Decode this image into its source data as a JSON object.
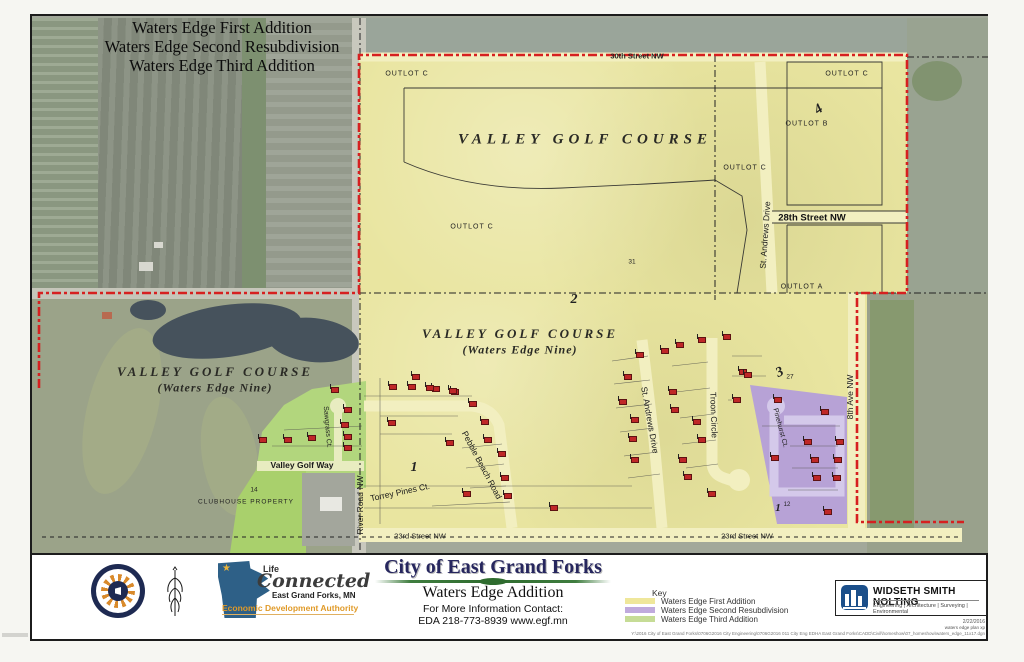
{
  "sheet": {
    "top_titles": [
      "Waters Edge First Addition",
      "Waters Edge Second Resubdivision",
      "Waters Edge Third Addition"
    ]
  },
  "map": {
    "golf_course_name": "VALLEY GOLF COURSE",
    "waters_edge_nine": "(Waters Edge Nine)",
    "outlot_a": "OUTLOT A",
    "outlot_b": "OUTLOT B",
    "outlot_c": "OUTLOT C",
    "clubhouse_label": "CLUBHOUSE  PROPERTY",
    "lot_numbers": {
      "n31": "31",
      "n27": "27",
      "n14": "14",
      "n12": "12"
    },
    "phases": {
      "p1": "1",
      "p2": "2",
      "p3": "3",
      "p4": "4"
    },
    "streets": {
      "s30": "30th Street NW",
      "s28": "28th Street NW",
      "s23": "23rd Street NW",
      "st_andrews": "St. Andrews Drive",
      "troon": "Troon Circle",
      "pebble": "Pebble Beach Road",
      "torrey": "Torrey Pines Ct.",
      "sawgrass": "Sawgrass Ct.",
      "valley_golf_way": "Valley Golf Way",
      "pinehurst": "Pinehurst Ct.",
      "ave8": "8th Ave NW",
      "river_road": "River Road NW"
    },
    "houses": [
      [
        357,
        368
      ],
      [
        376,
        368
      ],
      [
        400,
        370
      ],
      [
        419,
        373
      ],
      [
        437,
        385
      ],
      [
        449,
        403
      ],
      [
        452,
        421
      ],
      [
        466,
        435
      ],
      [
        469,
        459
      ],
      [
        472,
        477
      ],
      [
        431,
        475
      ],
      [
        356,
        404
      ],
      [
        414,
        424
      ],
      [
        518,
        489
      ],
      [
        380,
        358
      ],
      [
        394,
        369
      ],
      [
        417,
        372
      ],
      [
        604,
        336
      ],
      [
        629,
        332
      ],
      [
        592,
        358
      ],
      [
        587,
        383
      ],
      [
        599,
        401
      ],
      [
        597,
        420
      ],
      [
        599,
        441
      ],
      [
        637,
        373
      ],
      [
        639,
        391
      ],
      [
        661,
        403
      ],
      [
        666,
        421
      ],
      [
        647,
        441
      ],
      [
        652,
        458
      ],
      [
        676,
        475
      ],
      [
        644,
        326
      ],
      [
        666,
        321
      ],
      [
        691,
        318
      ],
      [
        707,
        353
      ],
      [
        701,
        381
      ],
      [
        712,
        356
      ],
      [
        742,
        381
      ],
      [
        789,
        393
      ],
      [
        772,
        423
      ],
      [
        804,
        423
      ],
      [
        739,
        439
      ],
      [
        779,
        441
      ],
      [
        802,
        441
      ],
      [
        781,
        459
      ],
      [
        801,
        459
      ],
      [
        792,
        493
      ],
      [
        299,
        371
      ],
      [
        312,
        391
      ],
      [
        309,
        406
      ],
      [
        312,
        418
      ],
      [
        312,
        429
      ],
      [
        227,
        421
      ],
      [
        252,
        421
      ],
      [
        276,
        419
      ]
    ]
  },
  "footer": {
    "city_title": "City of East Grand Forks",
    "addition_title": "Waters Edge Addition",
    "contact_line1": "For More Information Contact:",
    "contact_line2": "EDA 218-773-8939  www.egf.mn",
    "mn_logo": {
      "star": "★",
      "life": "Life",
      "connected": "Connected",
      "city": "East Grand Forks, MN",
      "authority": "Economic Development Authority"
    },
    "key": {
      "title": "Key",
      "items": [
        {
          "label": "Waters Edge First Addition",
          "color": "#efe79b"
        },
        {
          "label": "Waters Edge Second Resubdivision",
          "color": "#c0aadd"
        },
        {
          "label": "Waters Edge Third Addition",
          "color": "#c6dc96"
        }
      ]
    },
    "wsn": {
      "name": "WIDSETH SMITH NOLTING",
      "tagline": "Engineering | Architecture | Surveying | Environmental"
    },
    "plot_date": "2/22/2016",
    "plot_note": "waters edge plan xp",
    "plot_path": "Y:\\2016 City of East Grand Forks\\0706G2016 City Engineering\\0706G2016 011 City Eng EDHA East Grand Forks\\CADD\\Civil\\homeshow\\07_homeshow\\waters_edge_11x17.dgn"
  },
  "colors": {
    "first_addition_yellow": "#e9e5a0",
    "second_resub_purple": "#b7a2d6",
    "third_addition_green": "#b2d67d",
    "boundary_red": "#d62020"
  }
}
